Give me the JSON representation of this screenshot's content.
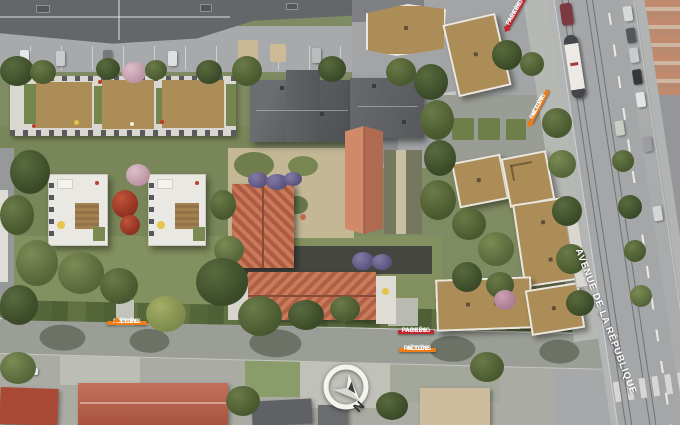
{
  "labels": {
    "street": "AVENUE DE LA RÉPUBLIQUE",
    "compass_north": "N",
    "access": [
      {
        "line1": "ACCÈS",
        "line2": "PARKING",
        "kind": "parking",
        "placement": "top-right"
      },
      {
        "line1": "ACCÈS",
        "line2": "PIÉTONS",
        "kind": "pietons",
        "placement": "right-avenue"
      },
      {
        "line1": "ACCÈS",
        "line2": "PIÉTONS",
        "kind": "pietons",
        "placement": "bottom-left-street"
      },
      {
        "line1": "ACCÈS",
        "line2": "PARKING",
        "kind": "parking",
        "placement": "bottom-center-street"
      },
      {
        "line1": "ACCÈS",
        "line2": "PIÉTONS",
        "kind": "pietons",
        "placement": "bottom-center-street-2"
      }
    ]
  },
  "icons": {
    "compass": "north-arrow-circle"
  },
  "colors": {
    "access_pietons": "#EE7D15",
    "access_parking": "#C1272D",
    "street_name_text": "#FFFFFF",
    "terracotta_roof": "#BE6C4F",
    "new_building_roof": "#AC8D58",
    "existing_roof_gray": "#64666A"
  }
}
